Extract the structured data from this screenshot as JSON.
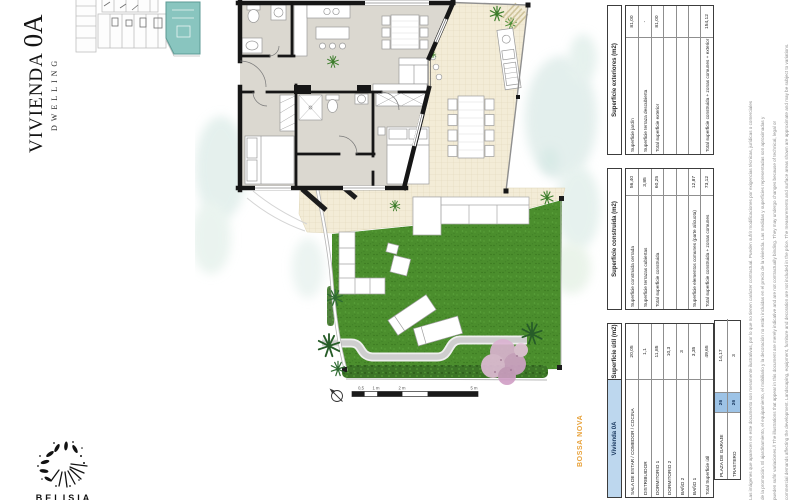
{
  "title": {
    "main": "VIVIENDA",
    "unit": "0A",
    "sub": "DWELLING"
  },
  "project": {
    "name": "BOSSA NOVA"
  },
  "logo": {
    "text": "BELISIA"
  },
  "colors": {
    "header_blue": "#bdd7ee",
    "badge_blue": "#9dc3e6",
    "highlight_teal": "#83c2bc",
    "brand_orange": "#e8a33d",
    "lawn_green": "#4b8e2d",
    "deck_cream": "#f3ecd7"
  },
  "tables": {
    "unit_header": "Vivienda 0A",
    "util": {
      "header": "Superficie útil (m2)",
      "rows": [
        {
          "label": "SALA DE ESTAR / COMEDOR / COCINA",
          "value": "20,05"
        },
        {
          "label": "DISTRIBUIDOR",
          "value": "1,1"
        },
        {
          "label": "DORMITORIO 1",
          "value": "11,85"
        },
        {
          "label": "DORMITORIO 2",
          "value": "10,3"
        },
        {
          "label": "BAÑO 2",
          "value": "3"
        },
        {
          "label": "BAÑO 1",
          "value": "3,35"
        },
        {
          "label": "Total Superficie útil",
          "value": "49,65"
        }
      ]
    },
    "construida": {
      "header": "Superficie construida (m2)",
      "rows": [
        {
          "label": "Superficie construida cerrada",
          "value": "56,40"
        },
        {
          "label": "Superficie terrazas cubiertas",
          "value": "3,85"
        },
        {
          "label": "Total superficie construida",
          "value": "60,25"
        },
        {
          "label": "",
          "value": ""
        },
        {
          "label": "",
          "value": ""
        },
        {
          "label": "Superficie elementos comunes (parte alícuota)",
          "value": "12,87"
        },
        {
          "label": "Total superficie construida + zonas comunes",
          "value": "73,12"
        }
      ]
    },
    "exteriores": {
      "header": "Superficie exteriores (m2)",
      "rows": [
        {
          "label": "Superficie jardín",
          "value": "81,00"
        },
        {
          "label": "Superficie terraza descubierta",
          "value": "-"
        },
        {
          "label": "Total superficie exterior",
          "value": "81,00"
        },
        {
          "label": "",
          "value": ""
        },
        {
          "label": "",
          "value": ""
        },
        {
          "label": "",
          "value": ""
        },
        {
          "label": "Total superficie construida + zonas comunes + exterior",
          "value": "154,12"
        }
      ]
    },
    "garage": {
      "rows": [
        {
          "label": "PLAZA DE GARAJE",
          "badge": "26",
          "value": "14,17"
        },
        {
          "label": "TRASTERO",
          "badge": "26",
          "value": "3"
        }
      ]
    }
  },
  "scalebar": {
    "labels": [
      "0,5",
      "1 m",
      "2 m",
      "5 m"
    ]
  },
  "disclaimer": {
    "line1": "Las imágenes que aparecen en este documento son meramente ilustrativas, por lo que no tienen carácter contractual. Pueden sufrir modificaciones por exigencias técnicas, jurídicas o comerciales",
    "line2": "de la promoción. El ajardinamiento, el equipamiento, el mobiliario y la decoración no están incluidas en el precio de la vivienda. Las medidas y superficies representadas son aproximadas y",
    "line3": "pueden sufrir variaciones.// The illustrations that appear in this document are merely indicative and are not contractually binding. They may undergo changes because of technical, legal or",
    "line4": "commercial demands affecting the development. Landscaping, equipment, furniture and decoration are not included in the price. The measurements and surface areas shown are approximate and may be subject to variations."
  }
}
